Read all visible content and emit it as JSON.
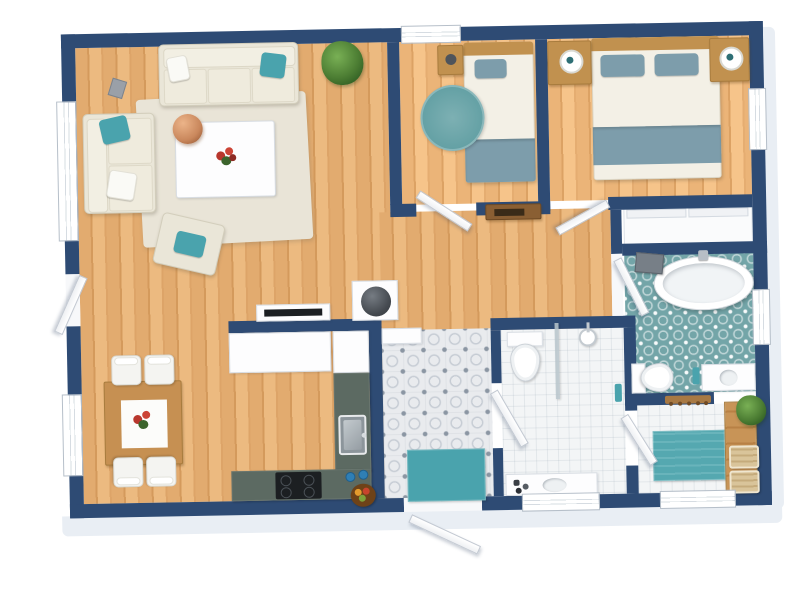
{
  "app": {
    "name": "3d-floor-plan-render",
    "description": "Top-down 3D rendered floor plan of an apartment with navy walls, wood floors and teal accents",
    "visible_text": []
  },
  "colors": {
    "wall": "#2e4b74",
    "wallEdge": "#e9eef4",
    "wood": "#e2ab6f",
    "woodMid": "#dda468",
    "woodDark": "#d49a5c",
    "woodLight": "#ecba80",
    "cream": "#eae6d8",
    "creamLight": "#f3f0e6",
    "teal": "#4aa3ad",
    "tealSoft": "#7d9dab",
    "tealTile": "#73a5a8",
    "counter": "#5c6a62",
    "tileBase": "#e9ebee",
    "tileDot": "#8b96a3",
    "tileRing": "#c6ccd4",
    "tileWhite": "#f3f5f6",
    "tableWood": "#c69052",
    "benchWood": "#c89457",
    "plant": "#2f5d22",
    "copper": "#c9875c",
    "basket": "#d9c49a",
    "rug": "#e9e4d7",
    "headboard": "#c1914f",
    "black": "#1c1f22"
  },
  "rooms": [
    {
      "id": "living-room",
      "floor": "wood-plank",
      "furniture": [
        "three-seat-sofa",
        "loveseat",
        "armchair",
        "coffee-table",
        "area-rug",
        "copper-pendant-lamp",
        "potted-plant",
        "floor-speaker",
        "tv-sideboard",
        "wood-stove",
        "flower-centerpiece"
      ]
    },
    {
      "id": "dining-area",
      "floor": "wood-plank",
      "furniture": [
        "dining-table",
        "dining-chair",
        "dining-chair",
        "dining-chair",
        "dining-chair",
        "flower-centerpiece"
      ]
    },
    {
      "id": "kitchen",
      "floor": "wood-plank",
      "furniture": [
        "cabinet-run",
        "refrigerator",
        "l-shaped-counter",
        "kitchen-sink",
        "cooktop",
        "fruit-bowl",
        "blue-jars"
      ]
    },
    {
      "id": "entry-hall",
      "floor": "patterned-cement-tile",
      "furniture": [
        "console-cabinet",
        "teal-doormat"
      ]
    },
    {
      "id": "small-bedroom",
      "floor": "wood-plank",
      "furniture": [
        "single-bed",
        "nightstand",
        "round-teal-rug"
      ]
    },
    {
      "id": "master-bedroom",
      "floor": "wood-plank",
      "furniture": [
        "double-bed",
        "nightstand",
        "nightstand",
        "table-lamp",
        "table-lamp",
        "built-in-closet"
      ]
    },
    {
      "id": "main-bathroom",
      "floor": "teal-pattern-tile",
      "furniture": [
        "freestanding-tub",
        "toilet",
        "vanity-sink",
        "wall-cabinet",
        "teal-towel"
      ]
    },
    {
      "id": "shower-bathroom",
      "floor": "white-tile",
      "furniture": [
        "toilet",
        "shower-head",
        "glass-partition",
        "vanity-sink",
        "teal-towel"
      ]
    },
    {
      "id": "utility-room",
      "floor": "white-tile",
      "furniture": [
        "wood-bench-counter",
        "wicker-basket",
        "wicker-basket",
        "teal-mat",
        "potted-plant",
        "coat-rack"
      ]
    }
  ],
  "openings": {
    "windows": [
      {
        "wall": "left",
        "room": "living-room"
      },
      {
        "wall": "left",
        "room": "dining-area"
      },
      {
        "wall": "top",
        "room": "small-bedroom"
      },
      {
        "wall": "right",
        "room": "master-bedroom"
      },
      {
        "wall": "right",
        "room": "main-bathroom"
      },
      {
        "wall": "bottom",
        "room": "shower-bathroom"
      },
      {
        "wall": "bottom",
        "room": "utility-room"
      }
    ],
    "doors": [
      {
        "id": "front-door",
        "from": "outside",
        "to": "entry-hall",
        "state": "open"
      },
      {
        "id": "side-door",
        "from": "outside",
        "to": "living-room",
        "state": "open"
      },
      {
        "id": "small-bedroom-door",
        "state": "open"
      },
      {
        "id": "master-bedroom-door",
        "state": "open"
      },
      {
        "id": "main-bathroom-door",
        "state": "open"
      },
      {
        "id": "shower-bathroom-door",
        "state": "open"
      },
      {
        "id": "utility-room-door",
        "state": "open"
      }
    ]
  }
}
